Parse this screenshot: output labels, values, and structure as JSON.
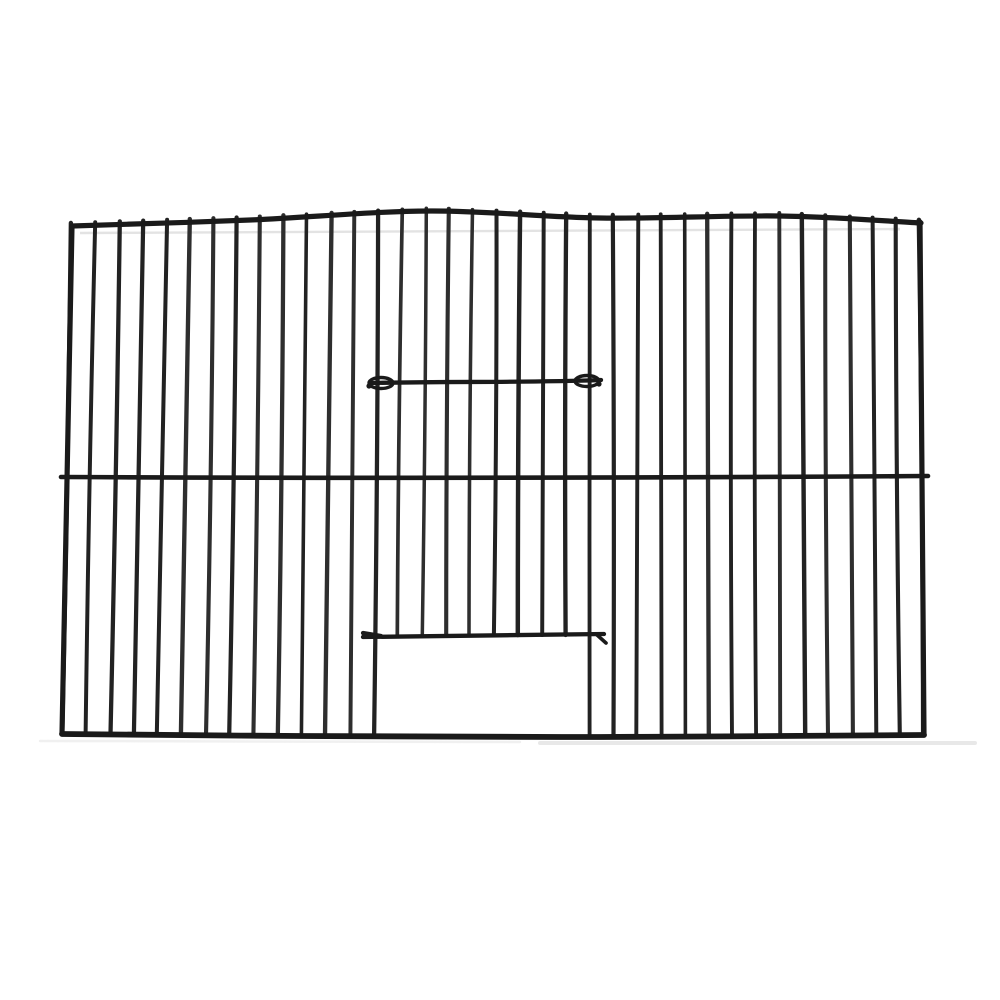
{
  "subject": {
    "kind": "product-photo",
    "item": "black wire bird-cage front panel with centre sliding door and open feeder hatch",
    "background_color": "#ffffff"
  },
  "colors": {
    "wire": "#222222",
    "wire_dark": "#1a1a1a",
    "wire_light": "#2e2e2e",
    "shadow": "#b9b9b9",
    "background": "#ffffff"
  },
  "panel": {
    "bar_count": 37,
    "bar_stroke": 4.0,
    "frame_stroke": 5.2,
    "rail_stroke": 4.6,
    "bar_top_protrusion": 3,
    "top_frame_points": [
      [
        72,
        226
      ],
      [
        250,
        220
      ],
      [
        430,
        211
      ],
      [
        600,
        218
      ],
      [
        780,
        216
      ],
      [
        921,
        223
      ]
    ],
    "bottom_frame_points": [
      [
        62,
        734
      ],
      [
        300,
        736
      ],
      [
        600,
        737
      ],
      [
        924,
        735
      ]
    ],
    "left_edge": {
      "top": [
        72,
        226
      ],
      "bottom": [
        62,
        734
      ]
    },
    "right_edge": {
      "top": [
        920,
        222
      ],
      "bottom": [
        924,
        735
      ]
    },
    "middle_rail": {
      "x1": 61,
      "y1": 477,
      "qx": 494,
      "qy": 479,
      "x2": 928,
      "y2": 476
    }
  },
  "door": {
    "top_bar": {
      "x1": 372,
      "y1": 383,
      "cx1": 450,
      "cy1": 381,
      "cx2": 520,
      "cy2": 383,
      "x2": 601,
      "y2": 380,
      "stroke": 4.3
    },
    "left_hook": {
      "cx": 381,
      "cy": 383,
      "rx": 12,
      "ry": 5.5,
      "tip_x": 369,
      "tip_y": 386
    },
    "right_hook": {
      "cx": 587,
      "cy": 381,
      "rx": 12,
      "ry": 5.5,
      "tip_x": 599,
      "tip_y": 384
    },
    "bottom_bar": {
      "x1": 363,
      "y1": 637,
      "x2": 604,
      "y2": 634,
      "stroke": 4.3
    },
    "bottom_bar_left_tick": {
      "x1": 363,
      "y1": 633,
      "x2": 381,
      "y2": 636
    },
    "bottom_bar_right_tick": {
      "x1": 596,
      "y1": 634,
      "x2": 606,
      "y2": 643
    },
    "opening": {
      "x1": 383,
      "x2": 583,
      "y_top": 636,
      "y_bottom": 733
    }
  },
  "shadows": {
    "under_top_frame": {
      "x1": 80,
      "y1": 233,
      "x2": 900,
      "y2": 229,
      "stroke": 2.4,
      "opacity": 0.4
    },
    "ground_segments": [
      {
        "x1": 40,
        "y1": 741,
        "x2": 520,
        "y2": 742,
        "stroke": 2.5,
        "opacity": 0.22
      },
      {
        "x1": 540,
        "y1": 743,
        "x2": 975,
        "y2": 743,
        "stroke": 4,
        "opacity": 0.32
      }
    ]
  }
}
